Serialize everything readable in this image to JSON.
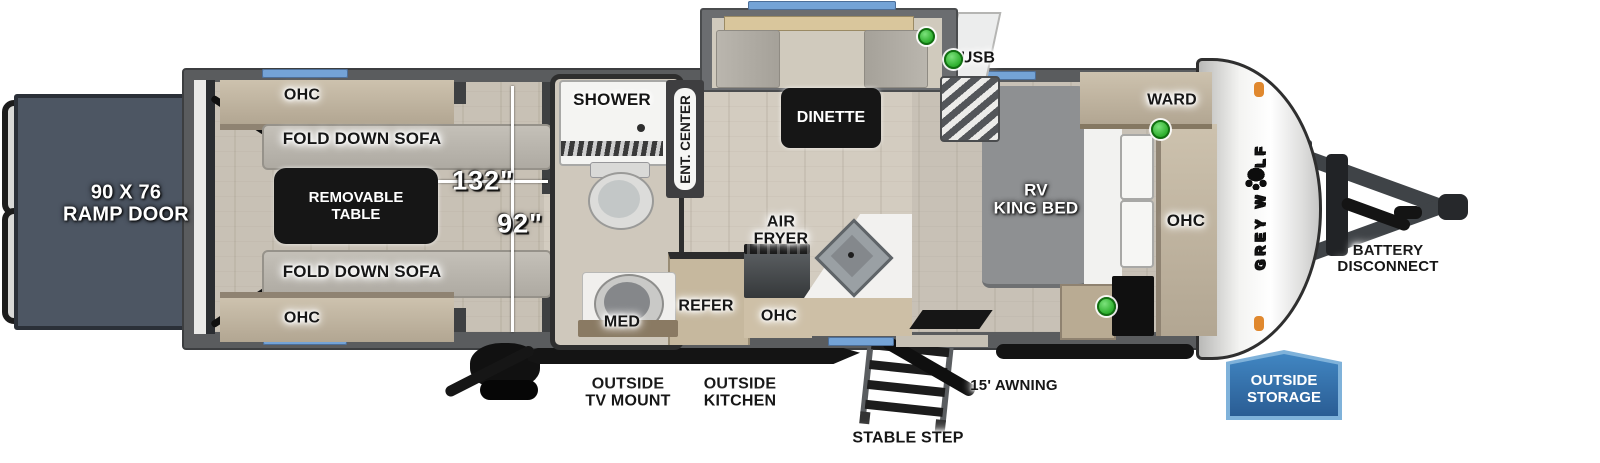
{
  "floorplan": {
    "brand": {
      "part1": "GREY W",
      "part2": "LF"
    },
    "exterior": {
      "ramp_door_line1": "90 X 76",
      "ramp_door_line2": "RAMP DOOR",
      "usb_legend": "USB",
      "battery_line1": "BATTERY",
      "battery_line2": "DISCONNECT",
      "outside_tv_line1": "OUTSIDE",
      "outside_tv_line2": "TV MOUNT",
      "outside_kitchen_line1": "OUTSIDE",
      "outside_kitchen_line2": "KITCHEN",
      "stable_step": "STABLE STEP",
      "awning": "15' AWNING",
      "storage_line1": "OUTSIDE",
      "storage_line2": "STORAGE"
    },
    "garage": {
      "ohc_top": "OHC",
      "sofa_top": "FOLD DOWN SOFA",
      "table_line1": "REMOVABLE",
      "table_line2": "TABLE",
      "sofa_bottom": "FOLD DOWN SOFA",
      "ohc_bottom": "OHC",
      "dim_length": "132\"",
      "dim_width": "92\""
    },
    "bathroom": {
      "shower": "SHOWER",
      "med": "MED"
    },
    "living": {
      "ent_center": "ENT. CENTER",
      "dinette": "DINETTE"
    },
    "kitchen": {
      "air_fryer_line1": "AIR",
      "air_fryer_line2": "FRYER",
      "refer": "REFER",
      "ohc": "OHC"
    },
    "bedroom": {
      "ward": "WARD",
      "ohc": "OHC",
      "bed_line1": "RV",
      "bed_line2": "KING BED"
    },
    "colors": {
      "window_blue": "#74a3d6",
      "usb_green": "#35b93a",
      "storage_badge_blue": "#2f6fae",
      "body_wall_gray": "#5a5c5e",
      "ramp_gray": "#4d5663"
    }
  }
}
